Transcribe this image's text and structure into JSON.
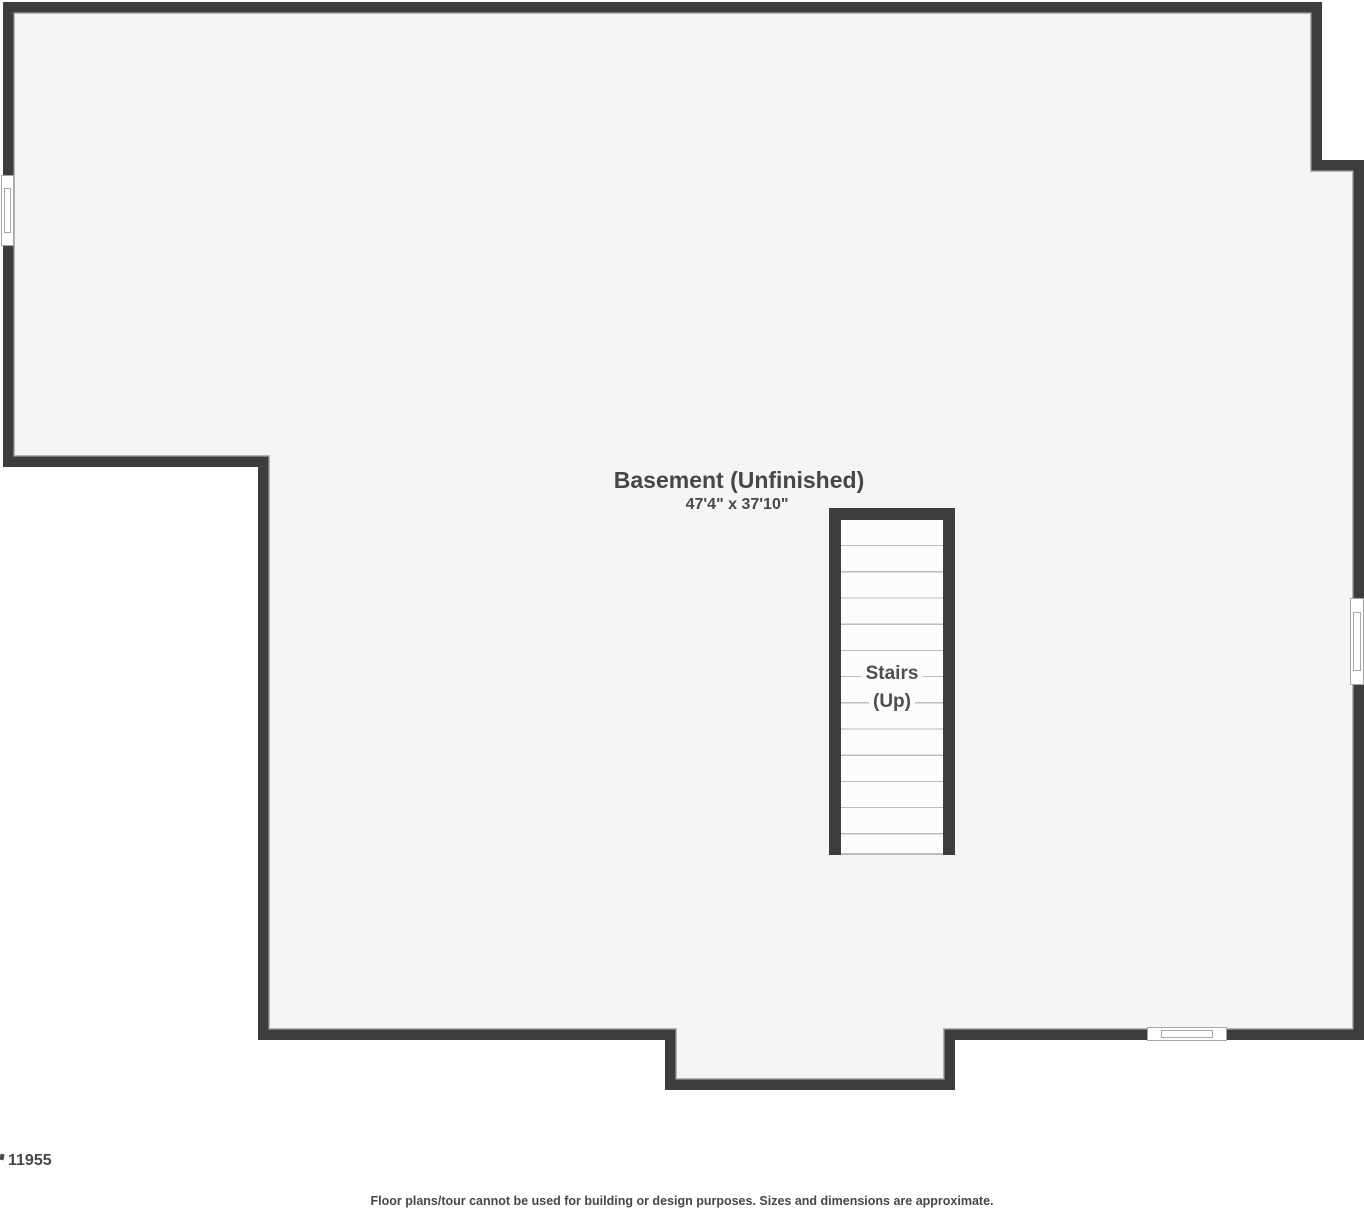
{
  "room": {
    "label": "Basement (Unfinished)",
    "dimensions": "47'4\" x 37'10\""
  },
  "stairs": {
    "label_line1": "Stairs",
    "label_line2": "(Up)"
  },
  "page": {
    "footer_id": "11955",
    "disclaimer": "Floor plans/tour cannot be used for building or design purposes. Sizes and dimensions are approximate."
  },
  "colors": {
    "wall": "#3d3d3d",
    "floor": "#f5f5f5",
    "edge_line": "#b3b3b3",
    "stairs_floor": "#fcfcfc",
    "step_line": "#bdbdbd",
    "window_line": "#a6a6a6",
    "text": "#474747",
    "stairs_text": "#4f4f4f"
  }
}
